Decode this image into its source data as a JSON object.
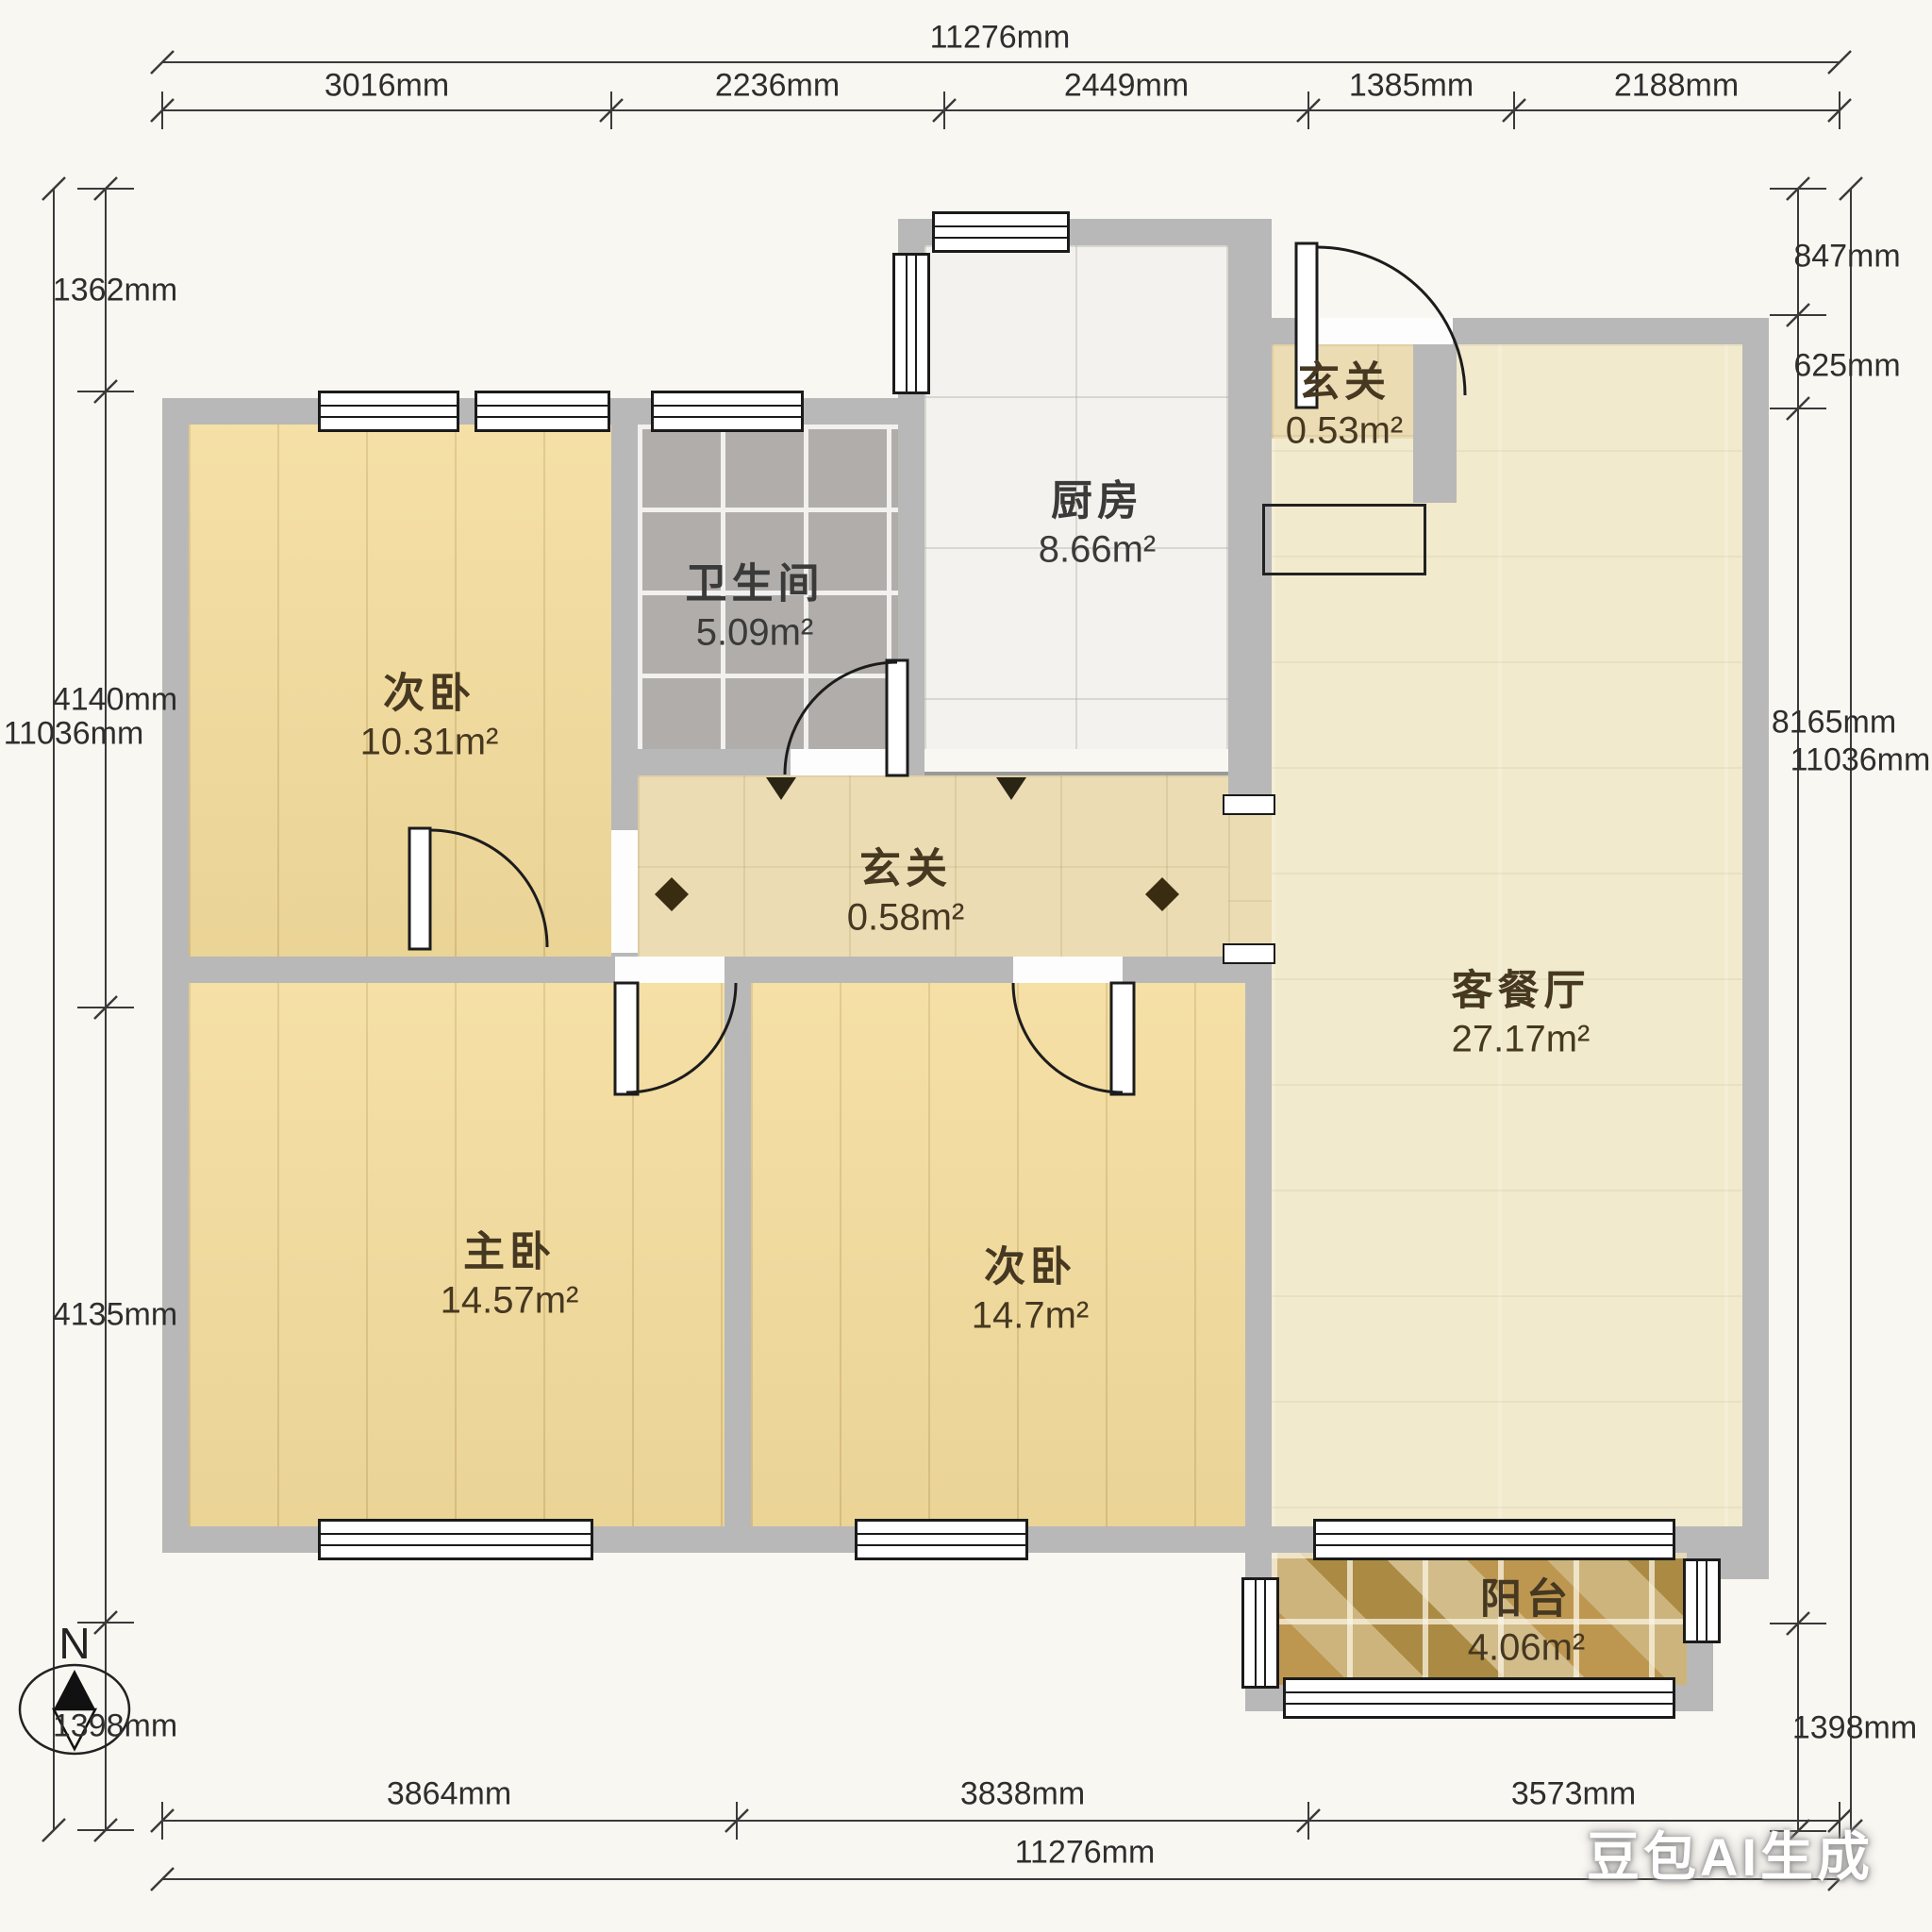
{
  "rooms": [
    {
      "name": "次卧",
      "area": "10.31m²"
    },
    {
      "name": "卫生间",
      "area": "5.09m²"
    },
    {
      "name": "厨房",
      "area": "8.66m²"
    },
    {
      "name": "玄关",
      "area": "0.53m²"
    },
    {
      "name": "玄关",
      "area": "0.58m²"
    },
    {
      "name": "客餐厅",
      "area": "27.17m²"
    },
    {
      "name": "主卧",
      "area": "14.57m²"
    },
    {
      "name": "次卧",
      "area": "14.7m²"
    },
    {
      "name": "阳台",
      "area": "4.06m²"
    }
  ],
  "dimensions": {
    "top": {
      "total": "11276mm",
      "segments": [
        "3016mm",
        "2236mm",
        "2449mm",
        "1385mm",
        "2188mm"
      ]
    },
    "bottom": {
      "total": "11276mm",
      "segments": [
        "3864mm",
        "3838mm",
        "3573mm"
      ]
    },
    "left": {
      "total": "11036mm",
      "segments": [
        "1362mm",
        "4140mm",
        "4135mm",
        "1398mm"
      ]
    },
    "right": {
      "total": "11036mm",
      "segments": [
        "847mm",
        "625mm",
        "8165mm",
        "1398mm"
      ]
    }
  },
  "compass": {
    "label": "N"
  },
  "watermark": "豆包AI生成",
  "colors": {
    "wall": "#b8b8b8",
    "wood_floor": "#f4dc9c",
    "bath_tile": "#b0adaa",
    "kitchen_tile": "#f4f2ee",
    "living_floor": "#f1eacd",
    "hall_tile": "#ebdcb4",
    "balcony_tile": "#c8ad74",
    "line": "#2e2e2e",
    "label_text": "#463821"
  }
}
